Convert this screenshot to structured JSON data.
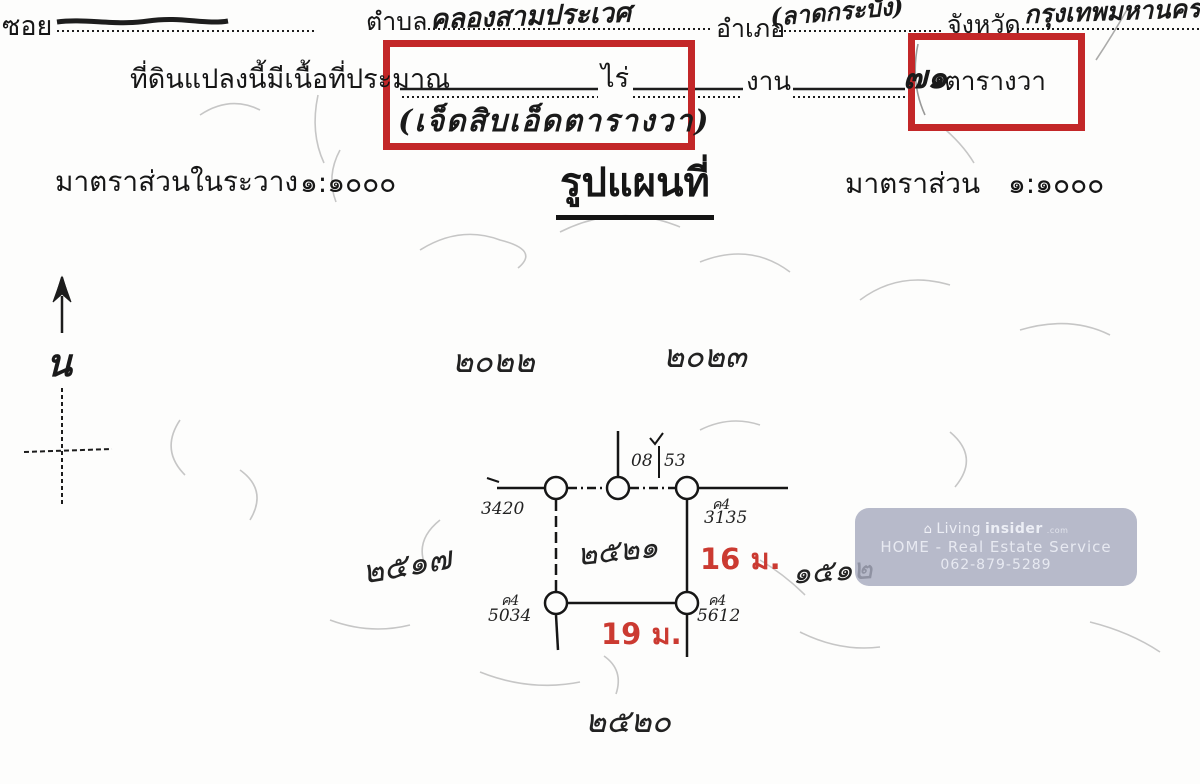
{
  "header": {
    "soi_label": "ซอย",
    "tambon_label": "ตำบล",
    "tambon_value": "คลองสามประเวศ",
    "amphoe_label": "อำเภอ",
    "amphoe_value": "(ลาดกระบัง)",
    "province_label": "จังหวัด",
    "province_value": "กรุงเทพมหานคร"
  },
  "area_line": {
    "prefix": "ที่ดินแปลงนี้มีเนื้อที่ประมาณ",
    "rai_label": "ไร่",
    "ngan_label": "งาน",
    "sqwa_value": "๗๑",
    "sqwa_label": "ตารางวา",
    "words_value": "(เจ็ดสิบเอ็ดตารางวา)"
  },
  "scale": {
    "left_label": "มาตราส่วนในระวาง",
    "left_value": "๑:๑๐๐๐",
    "map_title": "รูปแผนที่",
    "right_label": "มาตราส่วน",
    "right_value": "๑:๑๐๐๐"
  },
  "compass": {
    "north_label": "น"
  },
  "map": {
    "parcels": {
      "top_left": "๒๐๒๒",
      "top_right": "๒๐๒๓",
      "left": "๒๕๑๗",
      "right": "๑๕๑๒",
      "bottom": "๒๕๒๐",
      "center": "๒๕๒๑"
    },
    "markers": {
      "top_left_num": "3420",
      "top_mid_left": "08",
      "top_mid_right": "53",
      "top_right_code": "ค4",
      "top_right_num": "3135",
      "bottom_left_code": "ค4",
      "bottom_left_num": "5034",
      "bottom_right_code": "ค4",
      "bottom_right_num": "5612"
    },
    "dimensions": {
      "right": "16 ม.",
      "bottom": "19 ม."
    }
  },
  "watermark": {
    "brand_prefix": "Living",
    "brand_bold": "insider",
    "brand_tld": ".com",
    "line2": "HOME - Real Estate Service",
    "line3": "062-879-5289"
  },
  "colors": {
    "highlight_box": "#c32728",
    "dimension_text": "#cb3a31",
    "watermark_bg": "#a7abbe"
  }
}
